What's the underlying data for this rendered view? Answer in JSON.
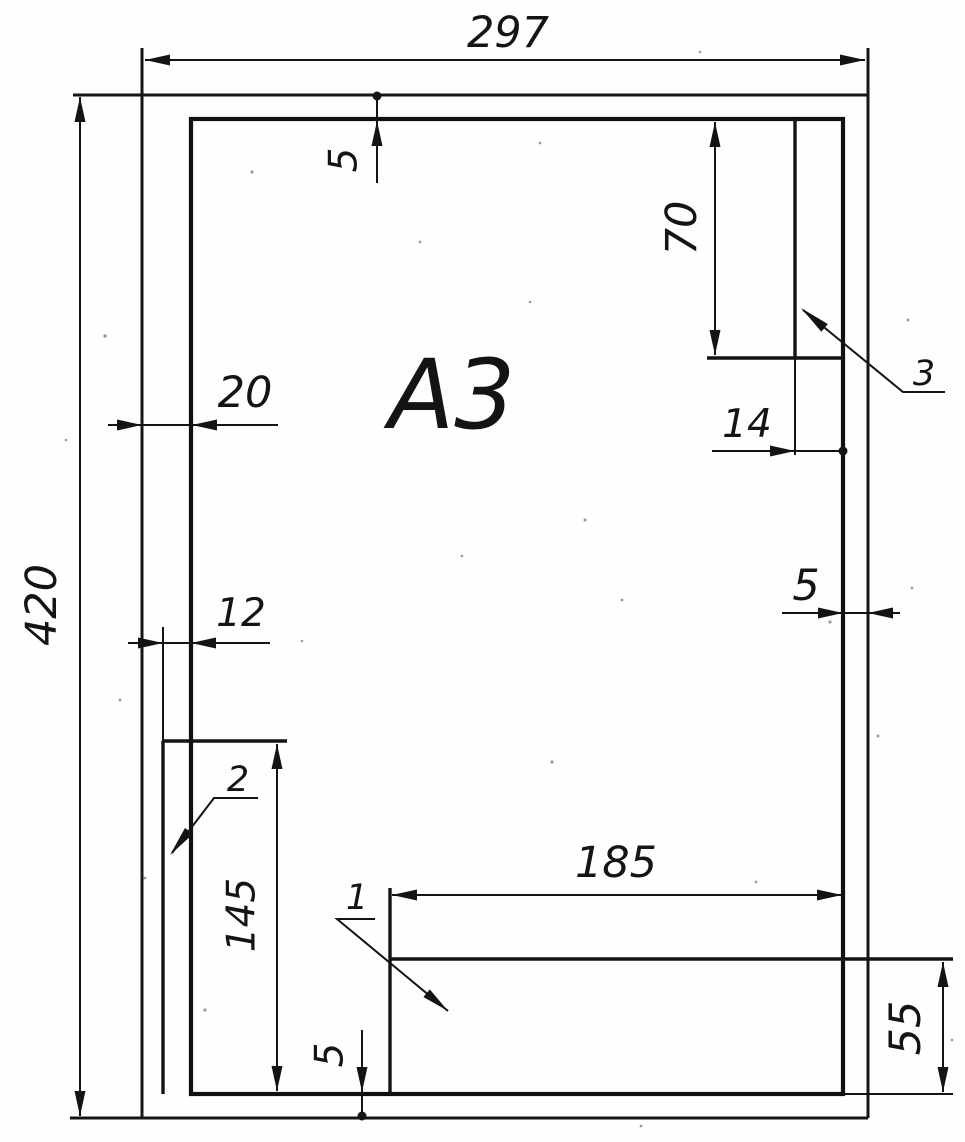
{
  "sheet": {
    "format_label": "А3"
  },
  "dims": {
    "width": "297",
    "height": "420",
    "margin_top": "5",
    "margin_right": "5",
    "margin_bottom": "5",
    "margin_left": "20",
    "side_strip_width": "12",
    "side_strip_length": "145",
    "corner_column_width": "14",
    "corner_column_length": "70",
    "title_block_width": "185",
    "title_block_height": "55"
  },
  "callouts": {
    "c1": "1",
    "c2": "2",
    "c3": "3"
  }
}
